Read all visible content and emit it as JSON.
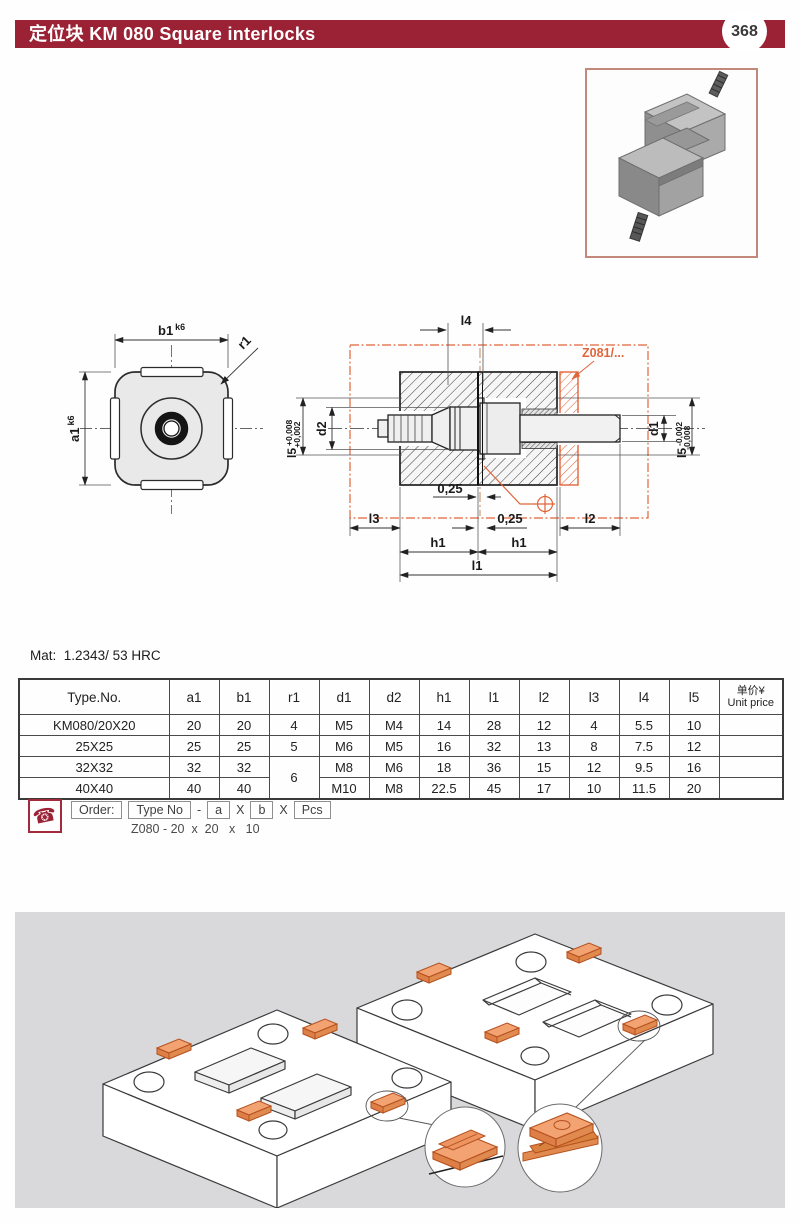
{
  "header": {
    "title": "定位块  KM 080  Square interlocks",
    "page_number": "368",
    "bar_color": "#9B2235"
  },
  "photo": {
    "name": "square-interlock-product-photo"
  },
  "drawing": {
    "accent_color": "#E0653B",
    "top_view": {
      "width_label": "b1",
      "width_tol": "k6",
      "height_label": "a1",
      "height_tol": "k6",
      "radius_label": "r1"
    },
    "section": {
      "l4": "l4",
      "d2": "d2",
      "d1": "d1",
      "l5_left": "l5",
      "l5_left_tol_upper": "+0,008",
      "l5_left_tol_lower": "+0,002",
      "l5_right": "l5",
      "l5_right_tol_upper": "-0,002",
      "l5_right_tol_lower": "-0,008",
      "gap_top": "0,25",
      "gap_bottom": "0,25",
      "l3": "l3",
      "l2": "l2",
      "h1_left": "h1",
      "h1_right": "h1",
      "l1": "l1",
      "ref_label": "Z081/..."
    }
  },
  "material": {
    "label": "Mat:",
    "value": "1.2343/ 53 HRC"
  },
  "table": {
    "columns": [
      "Type.No.",
      "a1",
      "b1",
      "r1",
      "d1",
      "d2",
      "h1",
      "l1",
      "l2",
      "l3",
      "l4",
      "l5"
    ],
    "price_column": {
      "line1": "单价¥",
      "line2": "Unit price"
    },
    "rows": [
      [
        "KM080/20X20",
        "20",
        "20",
        "4",
        "M5",
        "M4",
        "14",
        "28",
        "12",
        "4",
        "5.5",
        "10",
        ""
      ],
      [
        "25X25",
        "25",
        "25",
        "5",
        "M6",
        "M5",
        "16",
        "32",
        "13",
        "8",
        "7.5",
        "12",
        ""
      ],
      [
        "32X32",
        "32",
        "32",
        "6",
        "M8",
        "M6",
        "18",
        "36",
        "15",
        "12",
        "9.5",
        "16",
        ""
      ],
      [
        "40X40",
        "40",
        "40",
        null,
        "M10",
        "M8",
        "22.5",
        "45",
        "17",
        "10",
        "11.5",
        "20",
        ""
      ]
    ],
    "merge": {
      "row": 2,
      "col": 3,
      "rowspan": 2
    }
  },
  "order": {
    "label": "Order:",
    "type_no": "Type No",
    "dash": "-",
    "a": "a",
    "x1": "X",
    "b": "b",
    "x2": "X",
    "pcs": "Pcs",
    "example": "Z080 - 20  x  20   x   10"
  }
}
